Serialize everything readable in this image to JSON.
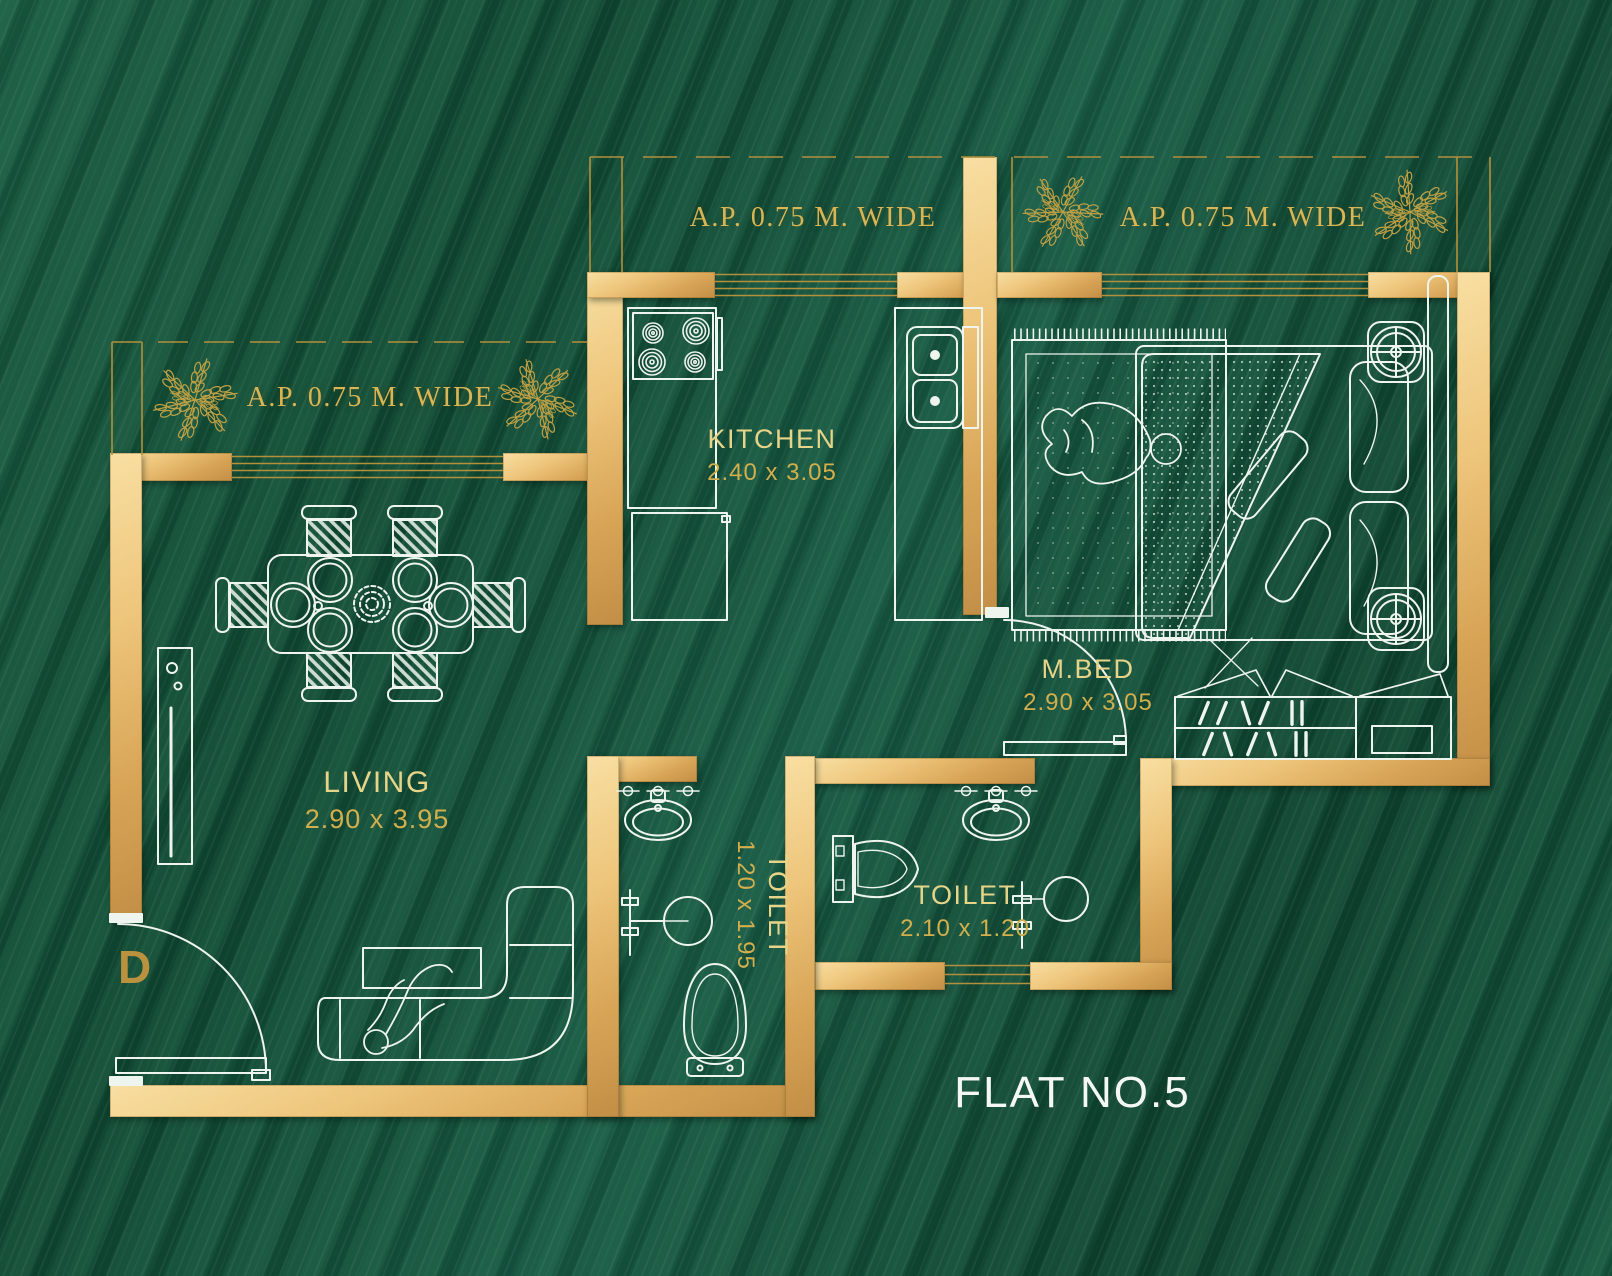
{
  "flat": {
    "label": "FLAT NO.5"
  },
  "entrance": {
    "door_label": "D"
  },
  "balconies": {
    "left": {
      "label": "A.P. 0.75 M. WIDE"
    },
    "top_inner": {
      "label": "A.P. 0.75 M. WIDE"
    },
    "top_outer": {
      "label": "A.P. 0.75 M. WIDE"
    }
  },
  "rooms": {
    "kitchen": {
      "name": "KITCHEN",
      "size": "2.40 x 3.05"
    },
    "master_bedroom": {
      "name": "M.BED",
      "size": "2.90 x 3.05"
    },
    "living": {
      "name": "LIVING",
      "size": "2.90 x 3.95"
    },
    "toilet_small": {
      "name": "TOILET",
      "size": "1.20 x 1.95"
    },
    "toilet_master": {
      "name": "TOILET",
      "size": "2.10 x 1.20"
    }
  },
  "icons": {
    "plant": "leaf-sprig-gold"
  },
  "colors": {
    "background_green": "#0F4A34",
    "wall_gold": "#D9A85C",
    "accent_gold": "#D6B44E",
    "label_yellow": "#E6D488",
    "line_white": "#F0F5F0"
  }
}
